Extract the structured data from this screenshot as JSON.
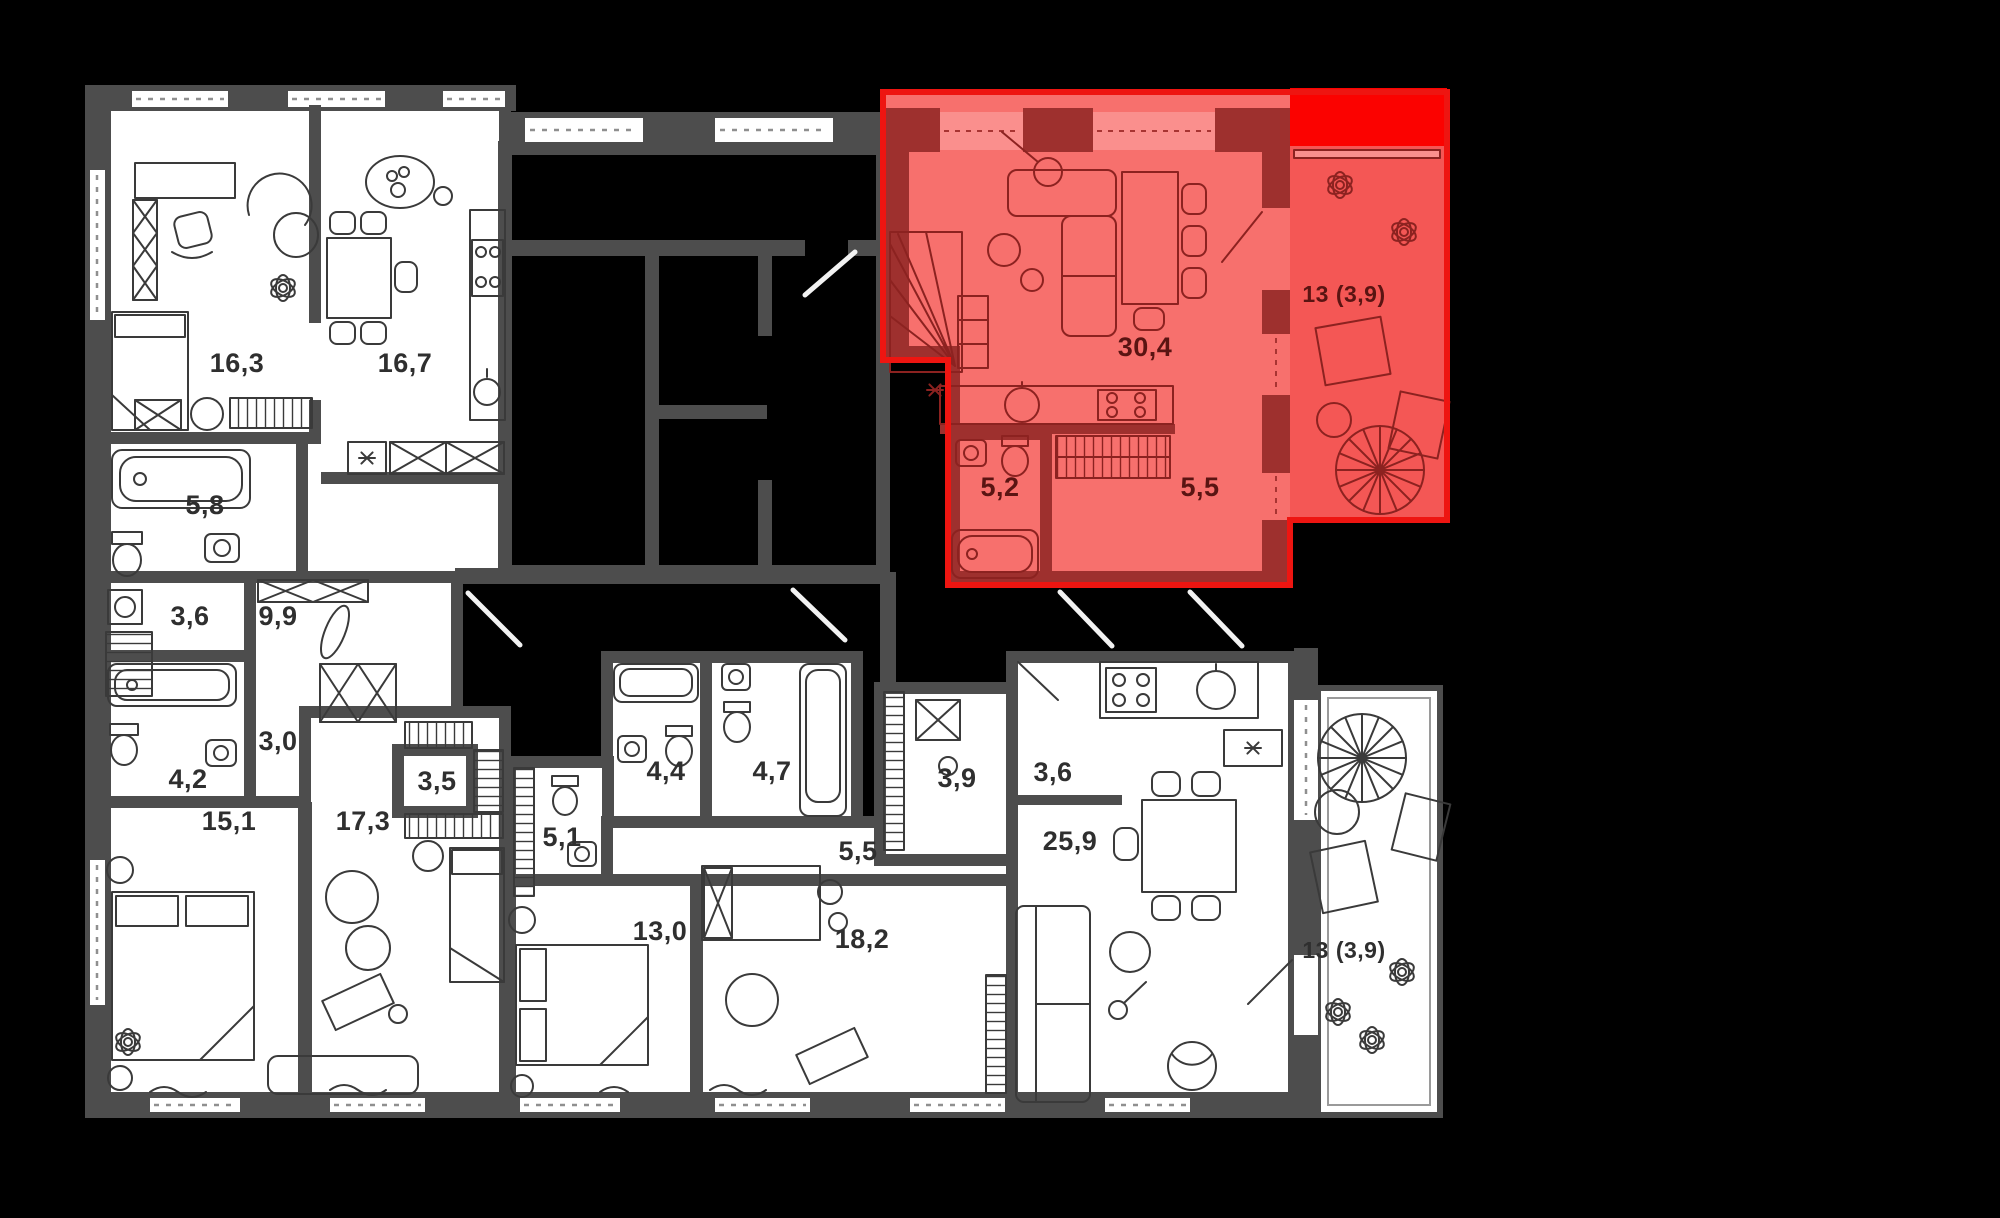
{
  "page": {
    "background": "#000000",
    "type": "apartment-floor-plan"
  },
  "colors": {
    "background": "#000000",
    "wall": "#4d4d4d",
    "room_fill": "#ffffff",
    "label": "#2f2f2f",
    "highlight_fill": "#f7706d",
    "highlight_balcony_fill": "#f45755",
    "highlight_top_strip": "#fb0200",
    "highlight_outline": "#ee1511",
    "highlight_wall": "#9e302e",
    "highlight_window": "#fa8f8d",
    "highlight_label": "#5a1412"
  },
  "floor_plan": {
    "rooms": [
      {
        "id": "room-16-3",
        "area": "16,3"
      },
      {
        "id": "room-16-7",
        "area": "16,7"
      },
      {
        "id": "room-5-8",
        "area": "5,8"
      },
      {
        "id": "room-3-6",
        "area": "3,6"
      },
      {
        "id": "room-9-9",
        "area": "9,9"
      },
      {
        "id": "room-3-0",
        "area": "3,0"
      },
      {
        "id": "room-4-2",
        "area": "4,2"
      },
      {
        "id": "room-15-1",
        "area": "15,1"
      },
      {
        "id": "room-17-3",
        "area": "17,3"
      },
      {
        "id": "room-3-5",
        "area": "3,5"
      },
      {
        "id": "room-5-1",
        "area": "5,1"
      },
      {
        "id": "room-4-4",
        "area": "4,4"
      },
      {
        "id": "room-4-7",
        "area": "4,7"
      },
      {
        "id": "room-3-9",
        "area": "3,9"
      },
      {
        "id": "room-3-6b",
        "area": "3,6"
      },
      {
        "id": "room-5-5b",
        "area": "5,5"
      },
      {
        "id": "room-25-9",
        "area": "25,9"
      },
      {
        "id": "room-13-0",
        "area": "13,0"
      },
      {
        "id": "room-18-2",
        "area": "18,2"
      },
      {
        "id": "terrace-bottom",
        "area": "13 (3,9)"
      }
    ],
    "highlighted_apartment": {
      "selected": true,
      "rooms": [
        {
          "id": "living-kitchen",
          "area": "30,4"
        },
        {
          "id": "bathroom",
          "area": "5,2"
        },
        {
          "id": "hall",
          "area": "5,5"
        },
        {
          "id": "terrace",
          "area": "13 (3,9)"
        }
      ]
    }
  }
}
